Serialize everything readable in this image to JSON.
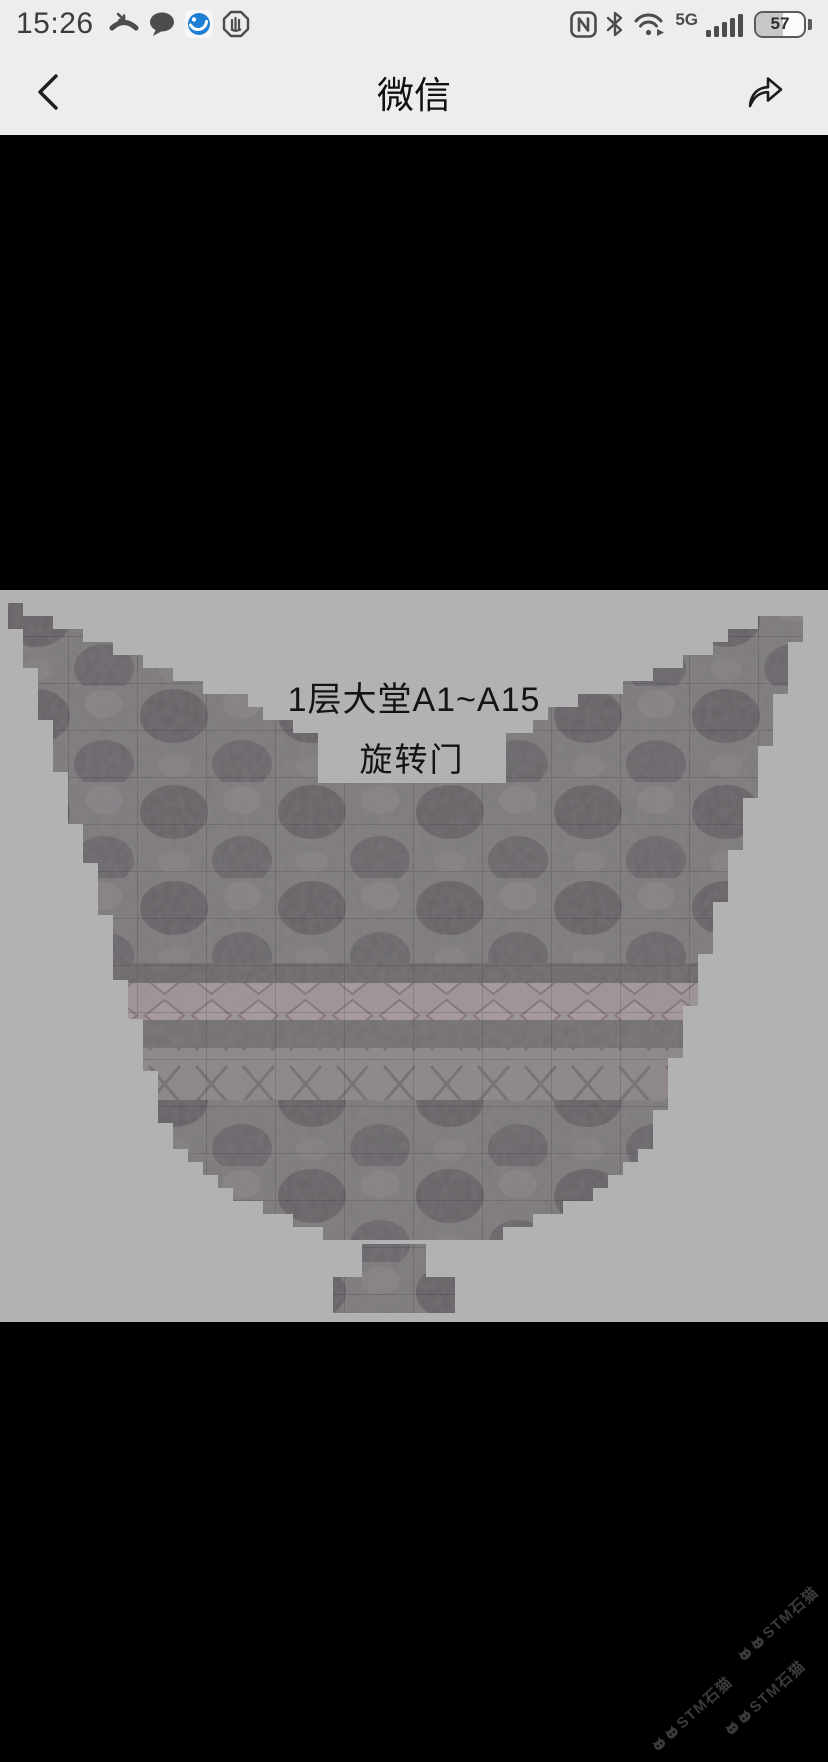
{
  "status_bar": {
    "time": "15:26",
    "network_type": "5G",
    "battery_percent": "57",
    "icons_left": [
      "missed-call-icon",
      "message-bubble-icon",
      "browser-app-icon",
      "hand-stop-icon"
    ],
    "icons_right": [
      "nfc-icon",
      "bluetooth-icon",
      "wifi-icon",
      "network-type-label",
      "signal-bars-icon",
      "battery-indicator"
    ]
  },
  "nav_bar": {
    "title": "微信",
    "back_icon": "chevron-left-icon",
    "share_icon": "forward-arrow-icon"
  },
  "photo": {
    "description": "stone floor layout plan of hotel lobby, fan-shaped tiled area on gray background",
    "area_label": "1层大堂A1~A15",
    "door_label": "旋转门"
  },
  "watermark": {
    "text": "STM石猫",
    "icon": "cat-logo-icon",
    "count": 3,
    "color": "#3a3a3a"
  },
  "colors": {
    "chrome_bg": "#ededed",
    "photo_bg": "#b2b1b3",
    "stone_base": "#7e7b7e",
    "viewer_bg": "#000000"
  }
}
